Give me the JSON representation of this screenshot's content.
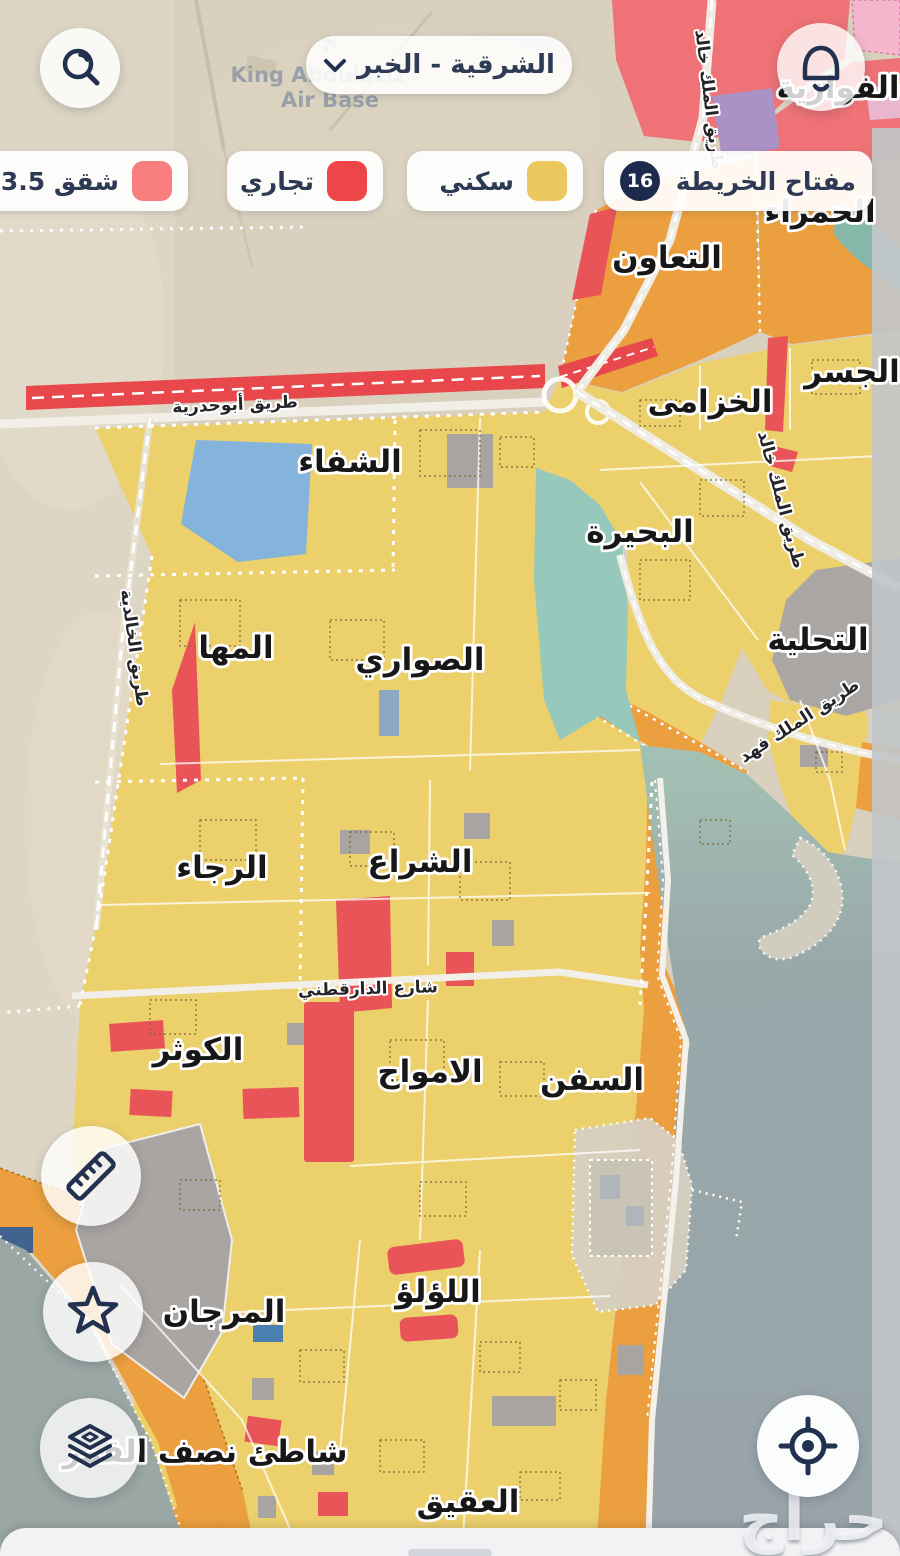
{
  "header": {
    "region_selector_label": "الشرقية - الخبر"
  },
  "legend": {
    "map_key": {
      "label": "مفتاح الخريطة",
      "count": "16"
    },
    "items": [
      {
        "id": "residential",
        "label": "سكني",
        "color": "#ecc85f"
      },
      {
        "id": "commercial",
        "label": "تجاري",
        "color": "#ee4549"
      },
      {
        "id": "apartments",
        "label": "شقق 3.5 م",
        "color": "#f87e7e"
      }
    ]
  },
  "map": {
    "base": {
      "airbase_line1": "King Abdulaziz",
      "airbase_line2": "Air Base",
      "airplane_icon": "✈"
    },
    "districts": [
      {
        "name": "الفوازية"
      },
      {
        "name": "الحمراء"
      },
      {
        "name": "التعاون"
      },
      {
        "name": "الجسر"
      },
      {
        "name": "الخزامى"
      },
      {
        "name": "الشفاء"
      },
      {
        "name": "البحيرة"
      },
      {
        "name": "التحلية"
      },
      {
        "name": "المها"
      },
      {
        "name": "الصواري"
      },
      {
        "name": "الرجاء"
      },
      {
        "name": "الشراع"
      },
      {
        "name": "الكوثر"
      },
      {
        "name": "الامواج"
      },
      {
        "name": "السفن"
      },
      {
        "name": "المرجان"
      },
      {
        "name": "اللؤلؤ"
      },
      {
        "name": "شاطئ نصف القمر"
      },
      {
        "name": "العقيق"
      }
    ],
    "roads": [
      {
        "name": "طريق أبوحدرية"
      },
      {
        "name": "طريق الخالدية"
      },
      {
        "name": "طريق الملك خالد"
      },
      {
        "name": "طريق الملك خالد"
      },
      {
        "name": "طريق الملك فهد"
      },
      {
        "name": "شارع الدارقطني"
      }
    ],
    "zone_colors": {
      "residential": "#ecd06c",
      "commercial": "#e85458",
      "apartments_salmon": "#ee7276",
      "services_orange": "#eb9f3f",
      "other_purple": "#aa92c6",
      "water_teal": "#96c9bb",
      "sea_gray": "#98a4aa"
    }
  },
  "watermark": "حراج"
}
